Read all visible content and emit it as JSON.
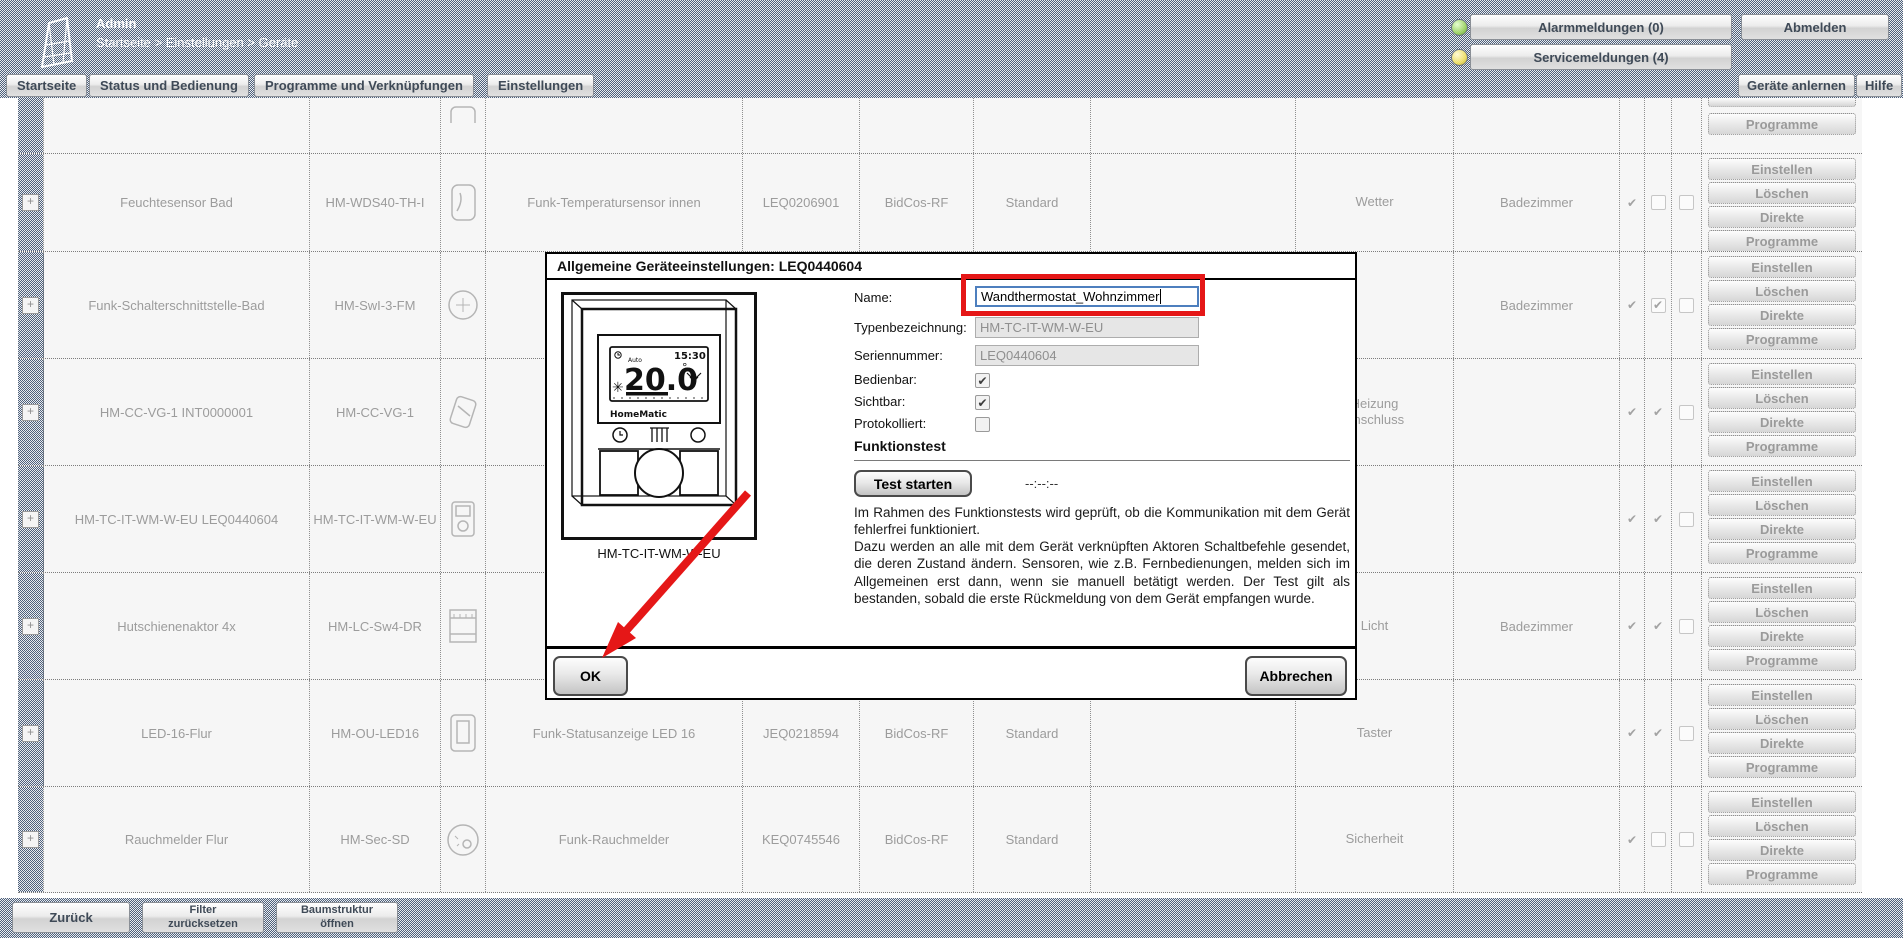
{
  "header": {
    "user": "Admin",
    "breadcrumb": "Startseite > Einstellungen > Geräte",
    "alarm_button": "Alarmmeldungen (0)",
    "logout_button": "Abmelden",
    "service_button": "Servicemeldungen (4)",
    "alarm_led_color": "#9fd36a",
    "service_led_color": "#ecdf6c"
  },
  "nav": {
    "items": [
      "Startseite",
      "Status und Bedienung",
      "Programme und Verknüpfungen",
      "Einstellungen"
    ],
    "teach_in_button": "Geräte anlernen",
    "help_button": "Hilfe"
  },
  "table": {
    "expand_glyph": "+",
    "action_labels": [
      "Einstellen",
      "Löschen",
      "Direkte",
      "Programme"
    ],
    "rows": [
      {
        "name": "",
        "model": "",
        "desc": "",
        "serial": "",
        "iface": "",
        "mode": "",
        "trade": "",
        "room": "",
        "checks": [
          "",
          "",
          ""
        ]
      },
      {
        "name": "Feuchtesensor Bad",
        "model": "HM-WDS40-TH-I",
        "desc": "Funk-Temperatursensor innen",
        "serial": "LEQ0206901",
        "iface": "BidCos-RF",
        "mode": "Standard",
        "trade": "Wetter",
        "room": "Badezimmer",
        "checks": [
          "✔",
          "",
          ""
        ]
      },
      {
        "name": "Funk-Schalterschnittstelle-Bad",
        "model": "HM-SwI-3-FM",
        "desc": "",
        "serial": "",
        "iface": "",
        "mode": "",
        "trade": "",
        "room": "Badezimmer",
        "checks": [
          "✔",
          "✔",
          ""
        ]
      },
      {
        "name": "HM-CC-VG-1 INT0000001",
        "model": "HM-CC-VG-1",
        "desc": "",
        "serial": "",
        "iface": "",
        "mode": "",
        "trade": "Heizung\nAnschluss",
        "room": "",
        "checks": [
          "✔",
          "✔",
          ""
        ]
      },
      {
        "name": "HM-TC-IT-WM-W-EU LEQ0440604",
        "model": "HM-TC-IT-WM-W-EU",
        "desc": "",
        "serial": "",
        "iface": "",
        "mode": "",
        "trade": "",
        "room": "",
        "checks": [
          "✔",
          "✔",
          ""
        ]
      },
      {
        "name": "Hutschienenaktor 4x",
        "model": "HM-LC-Sw4-DR",
        "desc": "",
        "serial": "",
        "iface": "",
        "mode": "",
        "trade": "Licht",
        "room": "Badezimmer",
        "checks": [
          "✔",
          "✔",
          ""
        ]
      },
      {
        "name": "LED-16-Flur",
        "model": "HM-OU-LED16",
        "desc": "Funk-Statusanzeige LED 16",
        "serial": "JEQ0218594",
        "iface": "BidCos-RF",
        "mode": "Standard",
        "trade": "Taster",
        "room": "",
        "checks": [
          "✔",
          "✔",
          ""
        ]
      },
      {
        "name": "Rauchmelder Flur",
        "model": "HM-Sec-SD",
        "desc": "Funk-Rauchmelder",
        "serial": "KEQ0745546",
        "iface": "BidCos-RF",
        "mode": "Standard",
        "trade": "Sicherheit",
        "room": "",
        "checks": [
          "✔",
          "",
          ""
        ]
      }
    ]
  },
  "dialog": {
    "title": "Allgemeine Geräteeinstellungen: LEQ0440604",
    "image_caption": "HM-TC-IT-WM-W-EU",
    "labels": {
      "name": "Name:",
      "type": "Typenbezeichnung:",
      "serial": "Seriennummer:",
      "operable": "Bedienbar:",
      "visible": "Sichtbar:",
      "logged": "Protokolliert:"
    },
    "values": {
      "name": "Wandthermostat_Wohnzimmer",
      "type": "HM-TC-IT-WM-W-EU",
      "serial": "LEQ0440604"
    },
    "checkboxes": {
      "operable": "✔",
      "visible": "✔",
      "logged": ""
    },
    "function_test": {
      "heading": "Funktionstest",
      "button": "Test starten",
      "timer": "--:--:--",
      "description": "Im Rahmen des Funktionstests wird geprüft, ob die Kommunikation mit dem Gerät fehlerfrei funktioniert.\nDazu werden an alle mit dem Gerät verknüpften Aktoren Schaltbefehle gesendet, die deren Zustand ändern. Sensoren, wie z.B. Fernbedienungen, melden sich im Allgemeinen erst dann, wenn sie manuell betätigt werden. Der Test gilt als bestanden, sobald die erste Rückmeldung von dem Gerät empfangen wurde."
    },
    "ok_button": "OK",
    "cancel_button": "Abbrechen",
    "thermostat_display": {
      "temp": "20.0",
      "degree": "°",
      "time": "15:30",
      "mode": "Auto",
      "brand": "HomeMatic"
    },
    "annotation_color": "#e51717"
  },
  "footer": {
    "back_button": "Zurück",
    "reset_filter_button": "Filter\nzurücksetzen",
    "tree_button": "Baumstruktur\nöffnen"
  }
}
